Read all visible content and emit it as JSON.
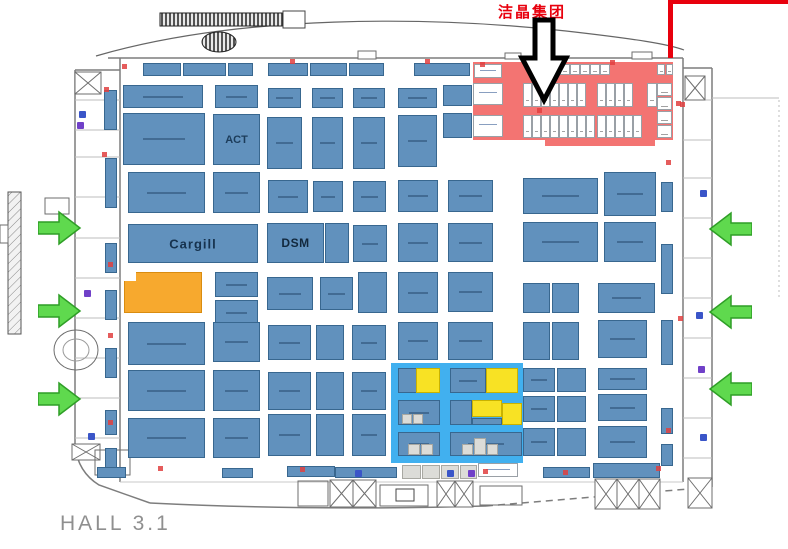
{
  "title": {
    "text": "HALL 3.1"
  },
  "annotation": {
    "company": "洁晶集团"
  },
  "colors": {
    "booth_fill": "#6191bd",
    "booth_border": "#38678f",
    "orange_fill": "#f7a92e",
    "orange_border": "#d98c10",
    "yellow_fill": "#f8e224",
    "yellow_border": "#c9b200",
    "white_fill": "#ffffff",
    "cell_border": "#9aa0a6",
    "gray_fill": "#dcdcd8",
    "gray_border": "#a8a8a2",
    "red_zone": "#f37472",
    "blue_zone": "#41b0ef",
    "arrow_green": "#5fd94e",
    "arrow_green_border": "#2f9e27",
    "annotation_red": "#e8000d",
    "wall_gray": "#7d7d7d"
  },
  "booths": [
    [
      143,
      63,
      38,
      13,
      "b"
    ],
    [
      183,
      63,
      43,
      13,
      "b"
    ],
    [
      228,
      63,
      25,
      13,
      "b"
    ],
    [
      268,
      63,
      40,
      13,
      "b"
    ],
    [
      310,
      63,
      37,
      13,
      "b"
    ],
    [
      349,
      63,
      35,
      13,
      "b"
    ],
    [
      414,
      63,
      56,
      13,
      "b"
    ],
    [
      104,
      90,
      13,
      40,
      "b"
    ],
    [
      105,
      158,
      12,
      50,
      "b"
    ],
    [
      105,
      243,
      12,
      30,
      "b"
    ],
    [
      105,
      290,
      12,
      30,
      "b"
    ],
    [
      105,
      348,
      12,
      30,
      "b"
    ],
    [
      105,
      410,
      12,
      25,
      "b"
    ],
    [
      105,
      448,
      12,
      22,
      "b"
    ],
    [
      661,
      182,
      12,
      30,
      "b"
    ],
    [
      661,
      244,
      12,
      50,
      "b"
    ],
    [
      661,
      320,
      12,
      45,
      "b"
    ],
    [
      661,
      408,
      12,
      26,
      "b"
    ],
    [
      661,
      444,
      12,
      22,
      "b"
    ],
    [
      123,
      85,
      80,
      23,
      "b"
    ],
    [
      215,
      85,
      43,
      23,
      "b"
    ],
    [
      268,
      88,
      33,
      20,
      "b"
    ],
    [
      312,
      88,
      31,
      20,
      "b"
    ],
    [
      353,
      88,
      32,
      20,
      "b"
    ],
    [
      398,
      88,
      39,
      20,
      "b"
    ],
    [
      443,
      85,
      29,
      21,
      "b"
    ],
    [
      123,
      113,
      82,
      52,
      "b"
    ],
    [
      213,
      114,
      47,
      51,
      "b",
      "ACT"
    ],
    [
      267,
      117,
      35,
      52,
      "b"
    ],
    [
      312,
      117,
      31,
      52,
      "b"
    ],
    [
      353,
      117,
      32,
      52,
      "b"
    ],
    [
      398,
      115,
      39,
      52,
      "b"
    ],
    [
      443,
      113,
      29,
      25,
      "b"
    ],
    [
      128,
      172,
      77,
      41,
      "b"
    ],
    [
      213,
      172,
      47,
      41,
      "b"
    ],
    [
      268,
      180,
      40,
      33,
      "b"
    ],
    [
      313,
      181,
      30,
      31,
      "b"
    ],
    [
      353,
      181,
      33,
      31,
      "b"
    ],
    [
      398,
      180,
      40,
      32,
      "b"
    ],
    [
      448,
      180,
      45,
      32,
      "b"
    ],
    [
      523,
      178,
      75,
      36,
      "b"
    ],
    [
      604,
      172,
      52,
      44,
      "b"
    ],
    [
      128,
      224,
      130,
      39,
      "b",
      "Cargill"
    ],
    [
      267,
      223,
      57,
      40,
      "b",
      "DSM"
    ],
    [
      325,
      223,
      24,
      40,
      "b"
    ],
    [
      353,
      225,
      34,
      37,
      "b"
    ],
    [
      398,
      223,
      40,
      39,
      "b"
    ],
    [
      448,
      223,
      45,
      39,
      "b"
    ],
    [
      523,
      222,
      75,
      40,
      "b"
    ],
    [
      604,
      222,
      52,
      40,
      "b"
    ],
    [
      124,
      272,
      78,
      41,
      "o"
    ],
    [
      215,
      272,
      43,
      25,
      "b"
    ],
    [
      215,
      300,
      43,
      25,
      "b"
    ],
    [
      267,
      277,
      46,
      33,
      "b"
    ],
    [
      320,
      277,
      33,
      33,
      "b"
    ],
    [
      358,
      272,
      29,
      41,
      "b"
    ],
    [
      398,
      272,
      40,
      41,
      "b"
    ],
    [
      448,
      272,
      45,
      40,
      "b"
    ],
    [
      523,
      283,
      27,
      30,
      "b"
    ],
    [
      552,
      283,
      27,
      30,
      "b"
    ],
    [
      598,
      283,
      57,
      30,
      "b"
    ],
    [
      128,
      322,
      77,
      43,
      "b"
    ],
    [
      213,
      322,
      47,
      40,
      "b"
    ],
    [
      268,
      325,
      43,
      35,
      "b"
    ],
    [
      316,
      325,
      28,
      35,
      "b"
    ],
    [
      352,
      325,
      34,
      35,
      "b"
    ],
    [
      398,
      322,
      40,
      38,
      "b"
    ],
    [
      448,
      322,
      45,
      38,
      "b"
    ],
    [
      523,
      322,
      27,
      38,
      "b"
    ],
    [
      552,
      322,
      27,
      38,
      "b"
    ],
    [
      598,
      320,
      49,
      38,
      "b"
    ],
    [
      128,
      370,
      77,
      41,
      "b"
    ],
    [
      213,
      370,
      47,
      41,
      "b"
    ],
    [
      268,
      372,
      43,
      38,
      "b"
    ],
    [
      316,
      372,
      28,
      38,
      "b"
    ],
    [
      352,
      372,
      34,
      38,
      "b"
    ],
    [
      523,
      368,
      32,
      24,
      "b"
    ],
    [
      557,
      368,
      29,
      24,
      "b"
    ],
    [
      598,
      368,
      49,
      22,
      "b"
    ],
    [
      523,
      396,
      32,
      26,
      "b"
    ],
    [
      557,
      396,
      29,
      26,
      "b"
    ],
    [
      598,
      394,
      49,
      27,
      "b"
    ],
    [
      128,
      418,
      77,
      40,
      "b"
    ],
    [
      213,
      418,
      47,
      40,
      "b"
    ],
    [
      268,
      414,
      43,
      42,
      "b"
    ],
    [
      316,
      414,
      28,
      42,
      "b"
    ],
    [
      352,
      414,
      34,
      42,
      "b"
    ],
    [
      523,
      428,
      32,
      28,
      "b"
    ],
    [
      557,
      428,
      29,
      28,
      "b"
    ],
    [
      598,
      426,
      49,
      32,
      "b"
    ],
    [
      97,
      467,
      29,
      11,
      "b"
    ],
    [
      222,
      468,
      31,
      10,
      "b"
    ],
    [
      287,
      466,
      48,
      11,
      "b"
    ],
    [
      335,
      467,
      62,
      11,
      "b"
    ],
    [
      543,
      467,
      47,
      11,
      "b"
    ],
    [
      593,
      463,
      67,
      15,
      "b"
    ],
    [
      402,
      465,
      19,
      14,
      "g"
    ],
    [
      422,
      465,
      18,
      14,
      "g"
    ],
    [
      441,
      465,
      18,
      14,
      "g"
    ],
    [
      460,
      465,
      17,
      14,
      "g"
    ],
    [
      473,
      62,
      200,
      78,
      "rz"
    ],
    [
      545,
      140,
      110,
      6,
      "rz"
    ],
    [
      474,
      64,
      28,
      14,
      "W"
    ],
    [
      473,
      83,
      30,
      22,
      "W"
    ],
    [
      473,
      115,
      30,
      22,
      "W"
    ],
    [
      530,
      64,
      10,
      11,
      "w"
    ],
    [
      540,
      64,
      10,
      11,
      "w"
    ],
    [
      550,
      64,
      10,
      11,
      "w"
    ],
    [
      560,
      64,
      10,
      11,
      "w"
    ],
    [
      570,
      64,
      10,
      11,
      "w"
    ],
    [
      580,
      64,
      10,
      11,
      "w"
    ],
    [
      590,
      64,
      10,
      11,
      "w"
    ],
    [
      600,
      64,
      10,
      11,
      "w"
    ],
    [
      657,
      64,
      8,
      11,
      "w"
    ],
    [
      666,
      64,
      7,
      11,
      "w"
    ],
    [
      523,
      83,
      9,
      24,
      "w"
    ],
    [
      532,
      83,
      9,
      24,
      "w"
    ],
    [
      541,
      83,
      9,
      24,
      "w"
    ],
    [
      550,
      83,
      9,
      24,
      "w"
    ],
    [
      559,
      83,
      9,
      24,
      "w"
    ],
    [
      568,
      83,
      9,
      24,
      "w"
    ],
    [
      577,
      83,
      9,
      24,
      "w"
    ],
    [
      597,
      83,
      9,
      24,
      "w"
    ],
    [
      606,
      83,
      9,
      24,
      "w"
    ],
    [
      615,
      83,
      9,
      24,
      "w"
    ],
    [
      624,
      83,
      9,
      24,
      "w"
    ],
    [
      647,
      83,
      10,
      24,
      "w"
    ],
    [
      657,
      83,
      15,
      13,
      "w"
    ],
    [
      657,
      97,
      15,
      13,
      "w"
    ],
    [
      657,
      111,
      15,
      13,
      "w"
    ],
    [
      657,
      125,
      15,
      13,
      "w"
    ],
    [
      523,
      115,
      9,
      23,
      "w"
    ],
    [
      532,
      115,
      9,
      23,
      "w"
    ],
    [
      541,
      115,
      9,
      23,
      "w"
    ],
    [
      550,
      115,
      9,
      23,
      "w"
    ],
    [
      559,
      115,
      9,
      23,
      "w"
    ],
    [
      568,
      115,
      9,
      23,
      "w"
    ],
    [
      577,
      115,
      9,
      23,
      "w"
    ],
    [
      586,
      115,
      9,
      23,
      "w"
    ],
    [
      597,
      115,
      9,
      23,
      "w"
    ],
    [
      606,
      115,
      9,
      23,
      "w"
    ],
    [
      615,
      115,
      9,
      23,
      "w"
    ],
    [
      624,
      115,
      9,
      23,
      "w"
    ],
    [
      633,
      115,
      9,
      23,
      "w"
    ],
    [
      478,
      463,
      40,
      14,
      "W"
    ],
    [
      391,
      363,
      132,
      100,
      "bz"
    ],
    [
      398,
      368,
      19,
      25,
      "b"
    ],
    [
      416,
      368,
      24,
      25,
      "y"
    ],
    [
      450,
      368,
      36,
      25,
      "b"
    ],
    [
      486,
      368,
      32,
      25,
      "y"
    ],
    [
      398,
      400,
      42,
      25,
      "b"
    ],
    [
      402,
      414,
      10,
      10,
      "g"
    ],
    [
      413,
      414,
      10,
      10,
      "g"
    ],
    [
      450,
      400,
      22,
      25,
      "b"
    ],
    [
      472,
      400,
      30,
      17,
      "y"
    ],
    [
      502,
      403,
      20,
      22,
      "y"
    ],
    [
      472,
      418,
      30,
      7,
      "b"
    ],
    [
      398,
      432,
      42,
      24,
      "b"
    ],
    [
      408,
      444,
      12,
      11,
      "g"
    ],
    [
      421,
      444,
      12,
      11,
      "g"
    ],
    [
      450,
      432,
      72,
      24,
      "b"
    ],
    [
      462,
      444,
      11,
      11,
      "g"
    ],
    [
      474,
      438,
      12,
      17,
      "g"
    ],
    [
      487,
      444,
      11,
      11,
      "g"
    ]
  ],
  "icons": {
    "blue": [
      [
        79,
        111
      ],
      [
        700,
        190
      ],
      [
        696,
        312
      ],
      [
        447,
        470
      ],
      [
        355,
        470
      ],
      [
        88,
        433
      ],
      [
        700,
        434
      ]
    ],
    "purple": [
      [
        77,
        122
      ],
      [
        84,
        290
      ],
      [
        468,
        470
      ],
      [
        698,
        366
      ]
    ]
  },
  "markers": [
    [
      122,
      64
    ],
    [
      290,
      59
    ],
    [
      425,
      59
    ],
    [
      480,
      62
    ],
    [
      610,
      60
    ],
    [
      104,
      87
    ],
    [
      102,
      152
    ],
    [
      108,
      262
    ],
    [
      108,
      333
    ],
    [
      108,
      420
    ],
    [
      680,
      102
    ],
    [
      666,
      160
    ],
    [
      678,
      316
    ],
    [
      666,
      428
    ],
    [
      483,
      469
    ],
    [
      563,
      470
    ],
    [
      656,
      466
    ],
    [
      300,
      467
    ],
    [
      158,
      466
    ],
    [
      676,
      101
    ],
    [
      537,
      108
    ]
  ],
  "arrows": {
    "left": [
      [
        38,
        209
      ],
      [
        38,
        292
      ],
      [
        38,
        380
      ]
    ],
    "right": [
      [
        708,
        210
      ],
      [
        708,
        293
      ],
      [
        708,
        370
      ]
    ]
  }
}
